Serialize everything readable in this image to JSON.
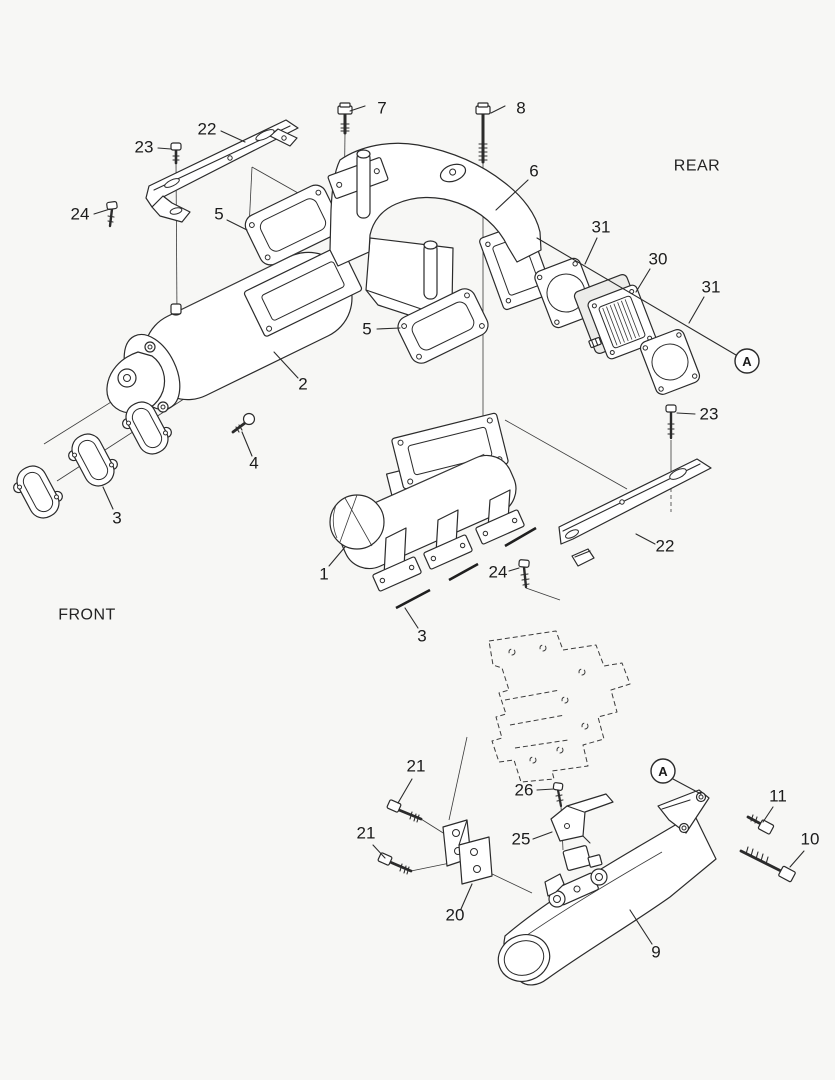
{
  "diagram": {
    "type": "exploded-parts-diagram",
    "direction_labels": [
      {
        "id": "front",
        "text": "FRONT",
        "x": 87,
        "y": 615
      },
      {
        "id": "rear",
        "text": "REAR",
        "x": 697,
        "y": 166
      }
    ],
    "view_markers": [
      {
        "id": "A-upper",
        "letter": "A",
        "cx": 747,
        "cy": 361,
        "r": 12,
        "leader": [
          [
            537,
            238
          ],
          [
            736,
            355
          ]
        ]
      },
      {
        "id": "A-lower",
        "letter": "A",
        "cx": 663,
        "cy": 771,
        "r": 12,
        "leader": [
          [
            673,
            779
          ],
          [
            701,
            794
          ]
        ]
      }
    ],
    "callouts": [
      {
        "id": "c7",
        "label": "7",
        "tx": 382,
        "ty": 108,
        "line": [
          [
            365,
            106
          ],
          [
            350,
            111
          ]
        ]
      },
      {
        "id": "c8",
        "label": "8",
        "tx": 521,
        "ty": 108,
        "line": [
          [
            505,
            106
          ],
          [
            491,
            113
          ]
        ]
      },
      {
        "id": "c6",
        "label": "6",
        "tx": 534,
        "ty": 171,
        "line": [
          [
            528,
            180
          ],
          [
            496,
            210
          ]
        ]
      },
      {
        "id": "c22t",
        "label": "22",
        "tx": 207,
        "ty": 129,
        "line": [
          [
            221,
            131
          ],
          [
            245,
            142
          ]
        ]
      },
      {
        "id": "c23t",
        "label": "23",
        "tx": 144,
        "ty": 147,
        "line": [
          [
            158,
            148
          ],
          [
            171,
            149
          ]
        ]
      },
      {
        "id": "c24t",
        "label": "24",
        "tx": 80,
        "ty": 214,
        "line": [
          [
            94,
            214
          ],
          [
            110,
            209
          ]
        ]
      },
      {
        "id": "c5t",
        "label": "5",
        "tx": 219,
        "ty": 214,
        "line": [
          [
            227,
            220
          ],
          [
            247,
            230
          ]
        ]
      },
      {
        "id": "c5b",
        "label": "5",
        "tx": 367,
        "ty": 329,
        "line": [
          [
            377,
            329
          ],
          [
            400,
            328
          ]
        ]
      },
      {
        "id": "c31a",
        "label": "31",
        "tx": 601,
        "ty": 227,
        "line": [
          [
            597,
            238
          ],
          [
            585,
            264
          ]
        ]
      },
      {
        "id": "c30",
        "label": "30",
        "tx": 658,
        "ty": 259,
        "line": [
          [
            650,
            269
          ],
          [
            636,
            292
          ]
        ]
      },
      {
        "id": "c31b",
        "label": "31",
        "tx": 711,
        "ty": 287,
        "line": [
          [
            704,
            297
          ],
          [
            689,
            323
          ]
        ]
      },
      {
        "id": "c2",
        "label": "2",
        "tx": 303,
        "ty": 384,
        "line": [
          [
            298,
            378
          ],
          [
            274,
            352
          ]
        ]
      },
      {
        "id": "c4",
        "label": "4",
        "tx": 254,
        "ty": 463,
        "line": [
          [
            252,
            456
          ],
          [
            242,
            432
          ]
        ]
      },
      {
        "id": "c3a",
        "label": "3",
        "tx": 117,
        "ty": 518,
        "line": [
          [
            113,
            509
          ],
          [
            103,
            487
          ]
        ]
      },
      {
        "id": "c23r",
        "label": "23",
        "tx": 709,
        "ty": 414,
        "line": [
          [
            695,
            414
          ],
          [
            677,
            413
          ]
        ]
      },
      {
        "id": "c22r",
        "label": "22",
        "tx": 665,
        "ty": 546,
        "line": [
          [
            655,
            544
          ],
          [
            636,
            534
          ]
        ]
      },
      {
        "id": "c24r",
        "label": "24",
        "tx": 498,
        "ty": 572,
        "line": [
          [
            509,
            571
          ],
          [
            519,
            568
          ]
        ]
      },
      {
        "id": "c1",
        "label": "1",
        "tx": 324,
        "ty": 574,
        "line": [
          [
            329,
            566
          ],
          [
            345,
            547
          ]
        ]
      },
      {
        "id": "c3b",
        "label": "3",
        "tx": 422,
        "ty": 636,
        "line": [
          [
            418,
            628
          ],
          [
            405,
            608
          ]
        ]
      },
      {
        "id": "c21a",
        "label": "21",
        "tx": 416,
        "ty": 766,
        "line": [
          [
            412,
            779
          ],
          [
            398,
            803
          ]
        ]
      },
      {
        "id": "c21b",
        "label": "21",
        "tx": 366,
        "ty": 833,
        "line": [
          [
            373,
            845
          ],
          [
            385,
            858
          ]
        ]
      },
      {
        "id": "c26",
        "label": "26",
        "tx": 524,
        "ty": 790,
        "line": [
          [
            537,
            790
          ],
          [
            554,
            789
          ]
        ]
      },
      {
        "id": "c25",
        "label": "25",
        "tx": 521,
        "ty": 839,
        "line": [
          [
            533,
            839
          ],
          [
            552,
            832
          ]
        ]
      },
      {
        "id": "c20",
        "label": "20",
        "tx": 455,
        "ty": 915,
        "line": [
          [
            461,
            909
          ],
          [
            472,
            884
          ]
        ]
      },
      {
        "id": "c11",
        "label": "11",
        "tx": 778,
        "ty": 796,
        "line": [
          [
            773,
            807
          ],
          [
            763,
            822
          ]
        ]
      },
      {
        "id": "c10",
        "label": "10",
        "tx": 810,
        "ty": 839,
        "line": [
          [
            804,
            851
          ],
          [
            790,
            867
          ]
        ]
      },
      {
        "id": "c9",
        "label": "9",
        "tx": 656,
        "ty": 952,
        "line": [
          [
            652,
            944
          ],
          [
            630,
            910
          ]
        ]
      }
    ],
    "colors": {
      "background": "#f7f7f5",
      "line": "#2b2b2b",
      "text": "#1b1b1b"
    }
  }
}
